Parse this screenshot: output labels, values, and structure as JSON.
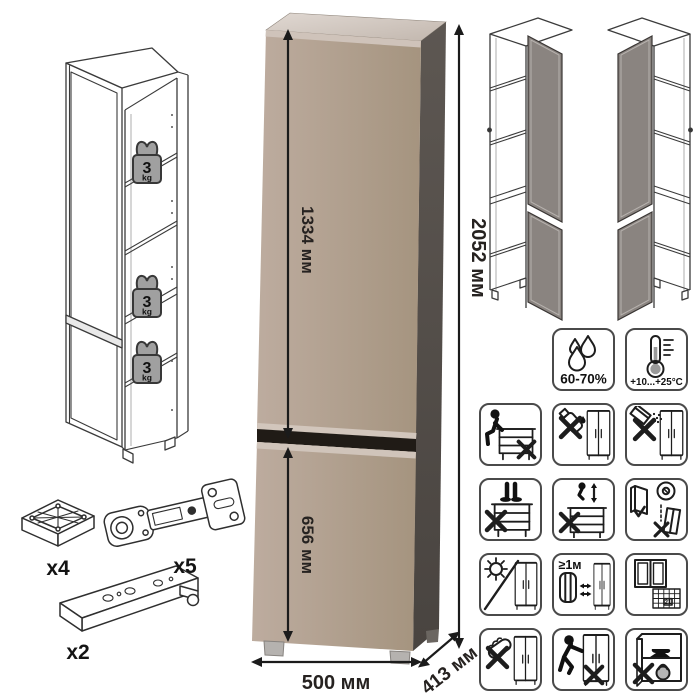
{
  "product": {
    "dimensions": {
      "upper_door": "1334 мм",
      "lower_door": "656 мм",
      "height": "2052 мм",
      "width": "500 мм",
      "depth": "413 мм"
    },
    "shelf_load": {
      "value": "3",
      "unit": "kg"
    },
    "hardware": {
      "foot": "x4",
      "hinge": "x5",
      "rail": "x2"
    },
    "care": {
      "humidity": "60-70%",
      "temperature": "+10...+25°C",
      "min_distance": "≥1м",
      "calendar_day": "21"
    }
  },
  "colors": {
    "front": "#b2a195",
    "front-light": "#bdac9f",
    "side": "#564f4a",
    "top": "#d8d0c9",
    "bevel": "#d0c4ba",
    "groove": "#201b16",
    "gray-door": "#8a8480"
  }
}
